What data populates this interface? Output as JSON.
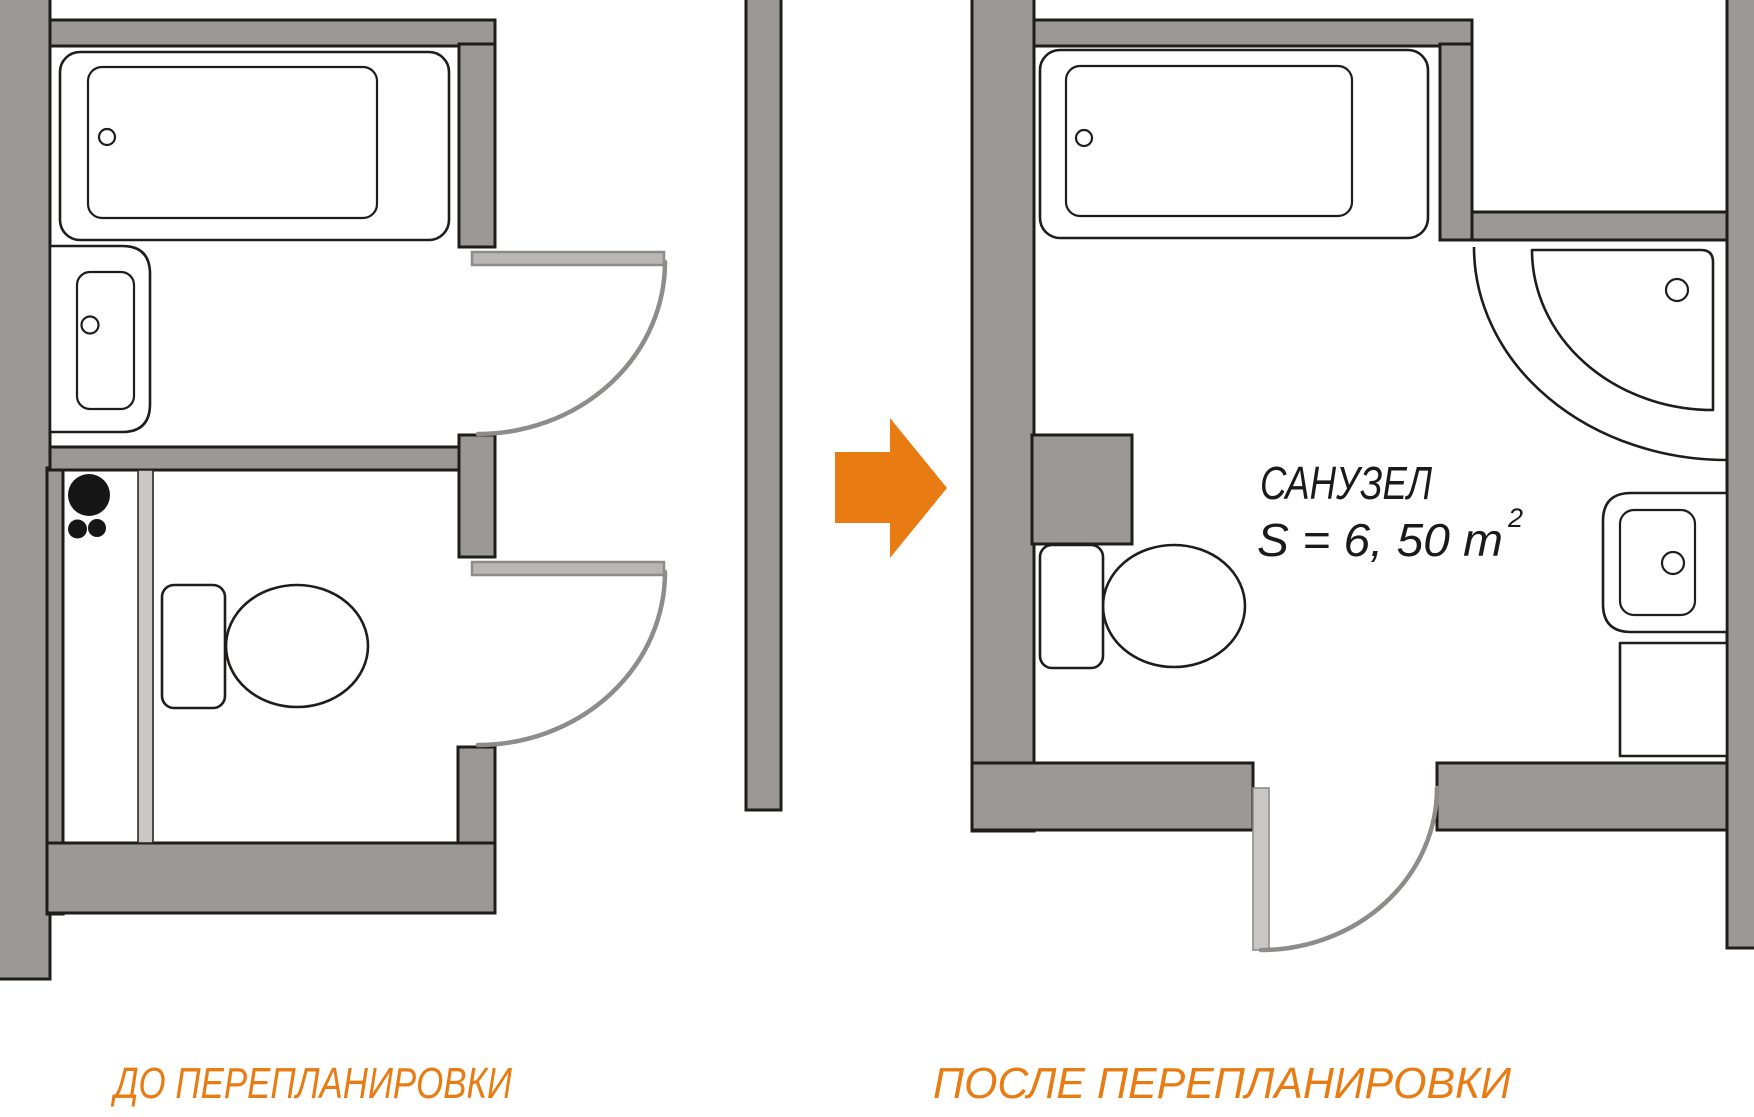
{
  "colors": {
    "background": "#ffffff",
    "wall": "#9b9997",
    "outline": "#1f1d1b",
    "door": "#8e8c8a",
    "doorleaf": "#b9b7b5",
    "partition": "#c9c7c5",
    "pipes": "#161616",
    "orange": "#e87c12",
    "text": "#1a1a1a"
  },
  "before_plan": {
    "caption": "ДО ПЕРЕПЛАНИРОВКИ",
    "fixtures": [
      "bathtub",
      "washbasin",
      "sewer-pipes",
      "partition",
      "toilet",
      "door-upper",
      "door-lower"
    ]
  },
  "after_plan": {
    "caption": "ПОСЛЕ ПЕРЕПЛАНИРОВКИ",
    "room_name": "САНУЗЕЛ",
    "room_area": "S = 6, 50 m",
    "room_area_sup": "2",
    "fixtures": [
      "bathtub",
      "corner-shower",
      "washbasin",
      "washing-machine",
      "toilet",
      "door",
      "pipe-shaft-pilaster"
    ]
  },
  "transform": {
    "arrow_direction": "right"
  }
}
